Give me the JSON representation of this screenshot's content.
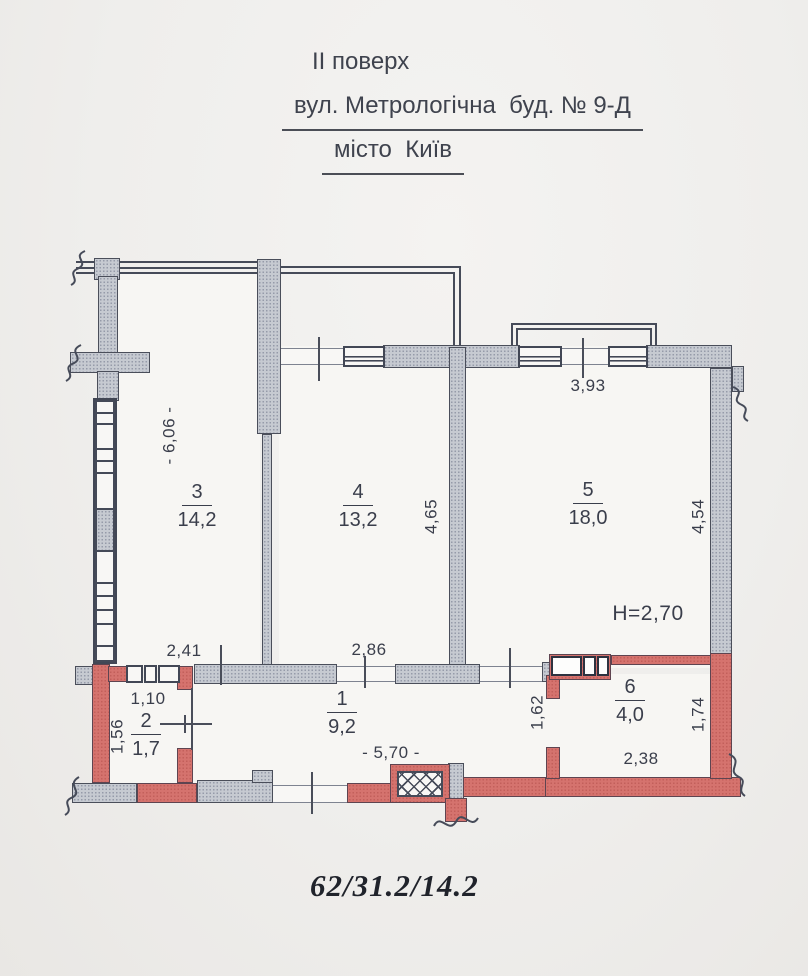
{
  "header": {
    "floor": "ІІ поверх",
    "address": "вул. Метрологічна  буд. № 9-Д",
    "city": "місто  Київ"
  },
  "footer": {
    "ratio": "62/31.2/14.2"
  },
  "plan": {
    "height_label": "H=2,70",
    "rooms": {
      "r1": {
        "num": "1",
        "area": "9,2"
      },
      "r2": {
        "num": "2",
        "area": "1,7"
      },
      "r3": {
        "num": "3",
        "area": "14,2"
      },
      "r4": {
        "num": "4",
        "area": "13,2"
      },
      "r5": {
        "num": "5",
        "area": "18,0"
      },
      "r6": {
        "num": "6",
        "area": "4,0"
      }
    },
    "dims": {
      "d241": "2,41",
      "d286": "2,86",
      "d110": "1,10",
      "d156": "1,56",
      "d570": "- 5,70 -",
      "d606": "- 6,06 -",
      "d465": "4,65",
      "d393": "3,93",
      "d454": "4,54",
      "d162": "1,62",
      "d238": "2,38",
      "d174": "1,74"
    },
    "colors": {
      "wall_gray": "#c6cad1",
      "wall_red": "#d5736e",
      "line": "#4a4e5a"
    }
  }
}
